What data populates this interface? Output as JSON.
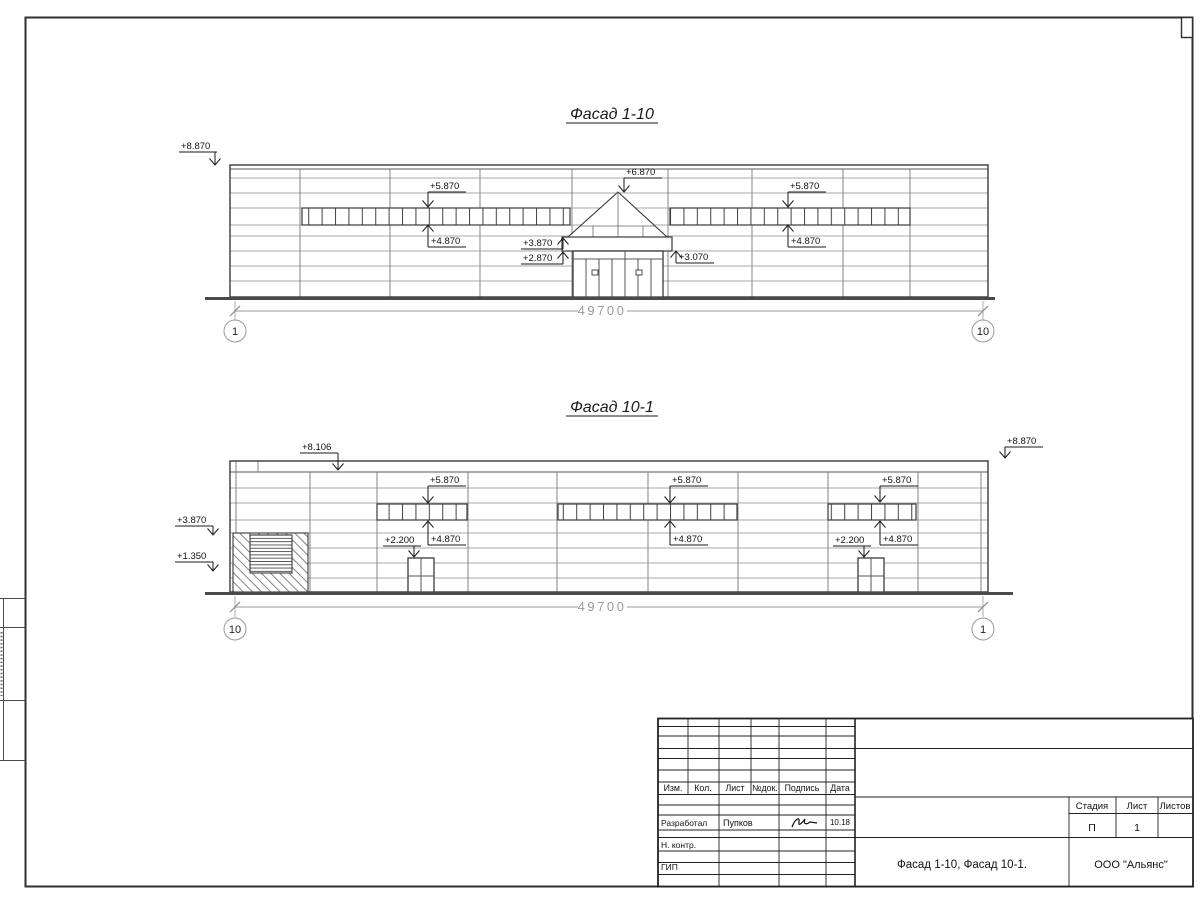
{
  "sheet": {
    "facade_top": {
      "title": "Фасад 1-10",
      "dimension": "49700",
      "axis_left": "1",
      "axis_right": "10",
      "marks": {
        "m8870": "+8.870",
        "m5870_left": "+5.870",
        "m5870_right": "+5.870",
        "m4870_left": "+4.870",
        "m4870_right": "+4.870",
        "m6870": "+6.870",
        "m3870": "+3.870",
        "m2870": "+2.870",
        "m3070": "+3.070"
      }
    },
    "facade_bottom": {
      "title": "Фасад 10-1",
      "dimension": "49700",
      "axis_left": "10",
      "axis_right": "1",
      "marks": {
        "m8106": "+8.106",
        "m8870": "+8.870",
        "m5870_a": "+5.870",
        "m5870_b": "+5.870",
        "m5870_c": "+5.870",
        "m4870_a": "+4.870",
        "m4870_b": "+4.870",
        "m4870_c": "+4.870",
        "m2200_a": "+2.200",
        "m2200_b": "+2.200",
        "m3870_out": "+3.870",
        "m1350_out": "+1.350"
      }
    },
    "titleblock": {
      "cols": {
        "izm": "Изм.",
        "kol": "Кол.",
        "list": "Лист",
        "ndok": "№док.",
        "podpis": "Подпись",
        "data": "Дата"
      },
      "developed_label": "Разработал",
      "developed_name": "Пупков",
      "developed_date": "10.18",
      "ncontr_label": "Н. контр.",
      "gip_label": "ГИП",
      "stage_label": "Стадия",
      "sheet_label": "Лист",
      "sheets_label": "Листов",
      "stage_value": "П",
      "sheet_value": "1",
      "doc_title": "Фасад 1-10, Фасад 10-1.",
      "company": "ООО \"Альянс\""
    },
    "colors": {
      "outline": "#3a3a3a",
      "panel_line": "#8f8f8f",
      "joint_line": "#777777",
      "dim": "#9a9a9a",
      "ground": "#4a4a4a"
    }
  }
}
